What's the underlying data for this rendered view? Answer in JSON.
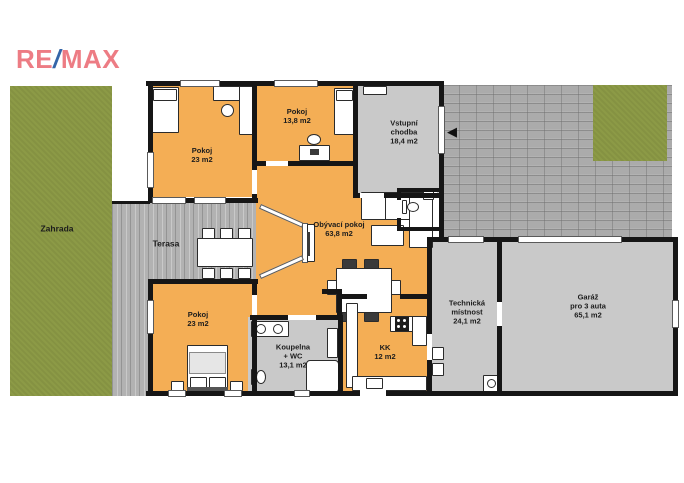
{
  "brand": {
    "re": "RE",
    "slash": "/",
    "max": "MAX"
  },
  "labels": {
    "zahrada": {
      "lines": [
        "Zahrada"
      ]
    },
    "terasa": {
      "lines": [
        "Terasa"
      ]
    },
    "pokoj_top": {
      "lines": [
        "Pokoj",
        "23 m2"
      ]
    },
    "pokoj_mid": {
      "lines": [
        "Pokoj",
        "13,8 m2"
      ]
    },
    "chodba": {
      "lines": [
        "Vstupní",
        "chodba",
        "18,4 m2"
      ]
    },
    "obyvaci": {
      "lines": [
        "Obývací pokoj",
        "63,8 m2"
      ]
    },
    "pokoj_bottom": {
      "lines": [
        "Pokoj",
        "23 m2"
      ]
    },
    "koupelna": {
      "lines": [
        "Koupelna",
        "+ WC",
        "13,1 m2"
      ]
    },
    "kk": {
      "lines": [
        "KK",
        "12 m2"
      ]
    },
    "technicka": {
      "lines": [
        "Technická",
        "místnost",
        "24,1 m2"
      ]
    },
    "garaz": {
      "lines": [
        "Garáž",
        "pro 3 auta",
        "65,1 m2"
      ]
    }
  },
  "icons": {
    "entrance_arrow": "◀"
  },
  "colors": {
    "floor_orange": "#f4ae55",
    "room_gray": "#c9c9c9",
    "garden_green": "#8c9a46",
    "wood_gray": "#b2b2b2",
    "wall_black": "#161616",
    "brand_red": "#ed7c84",
    "brand_blue": "#3565a8"
  }
}
